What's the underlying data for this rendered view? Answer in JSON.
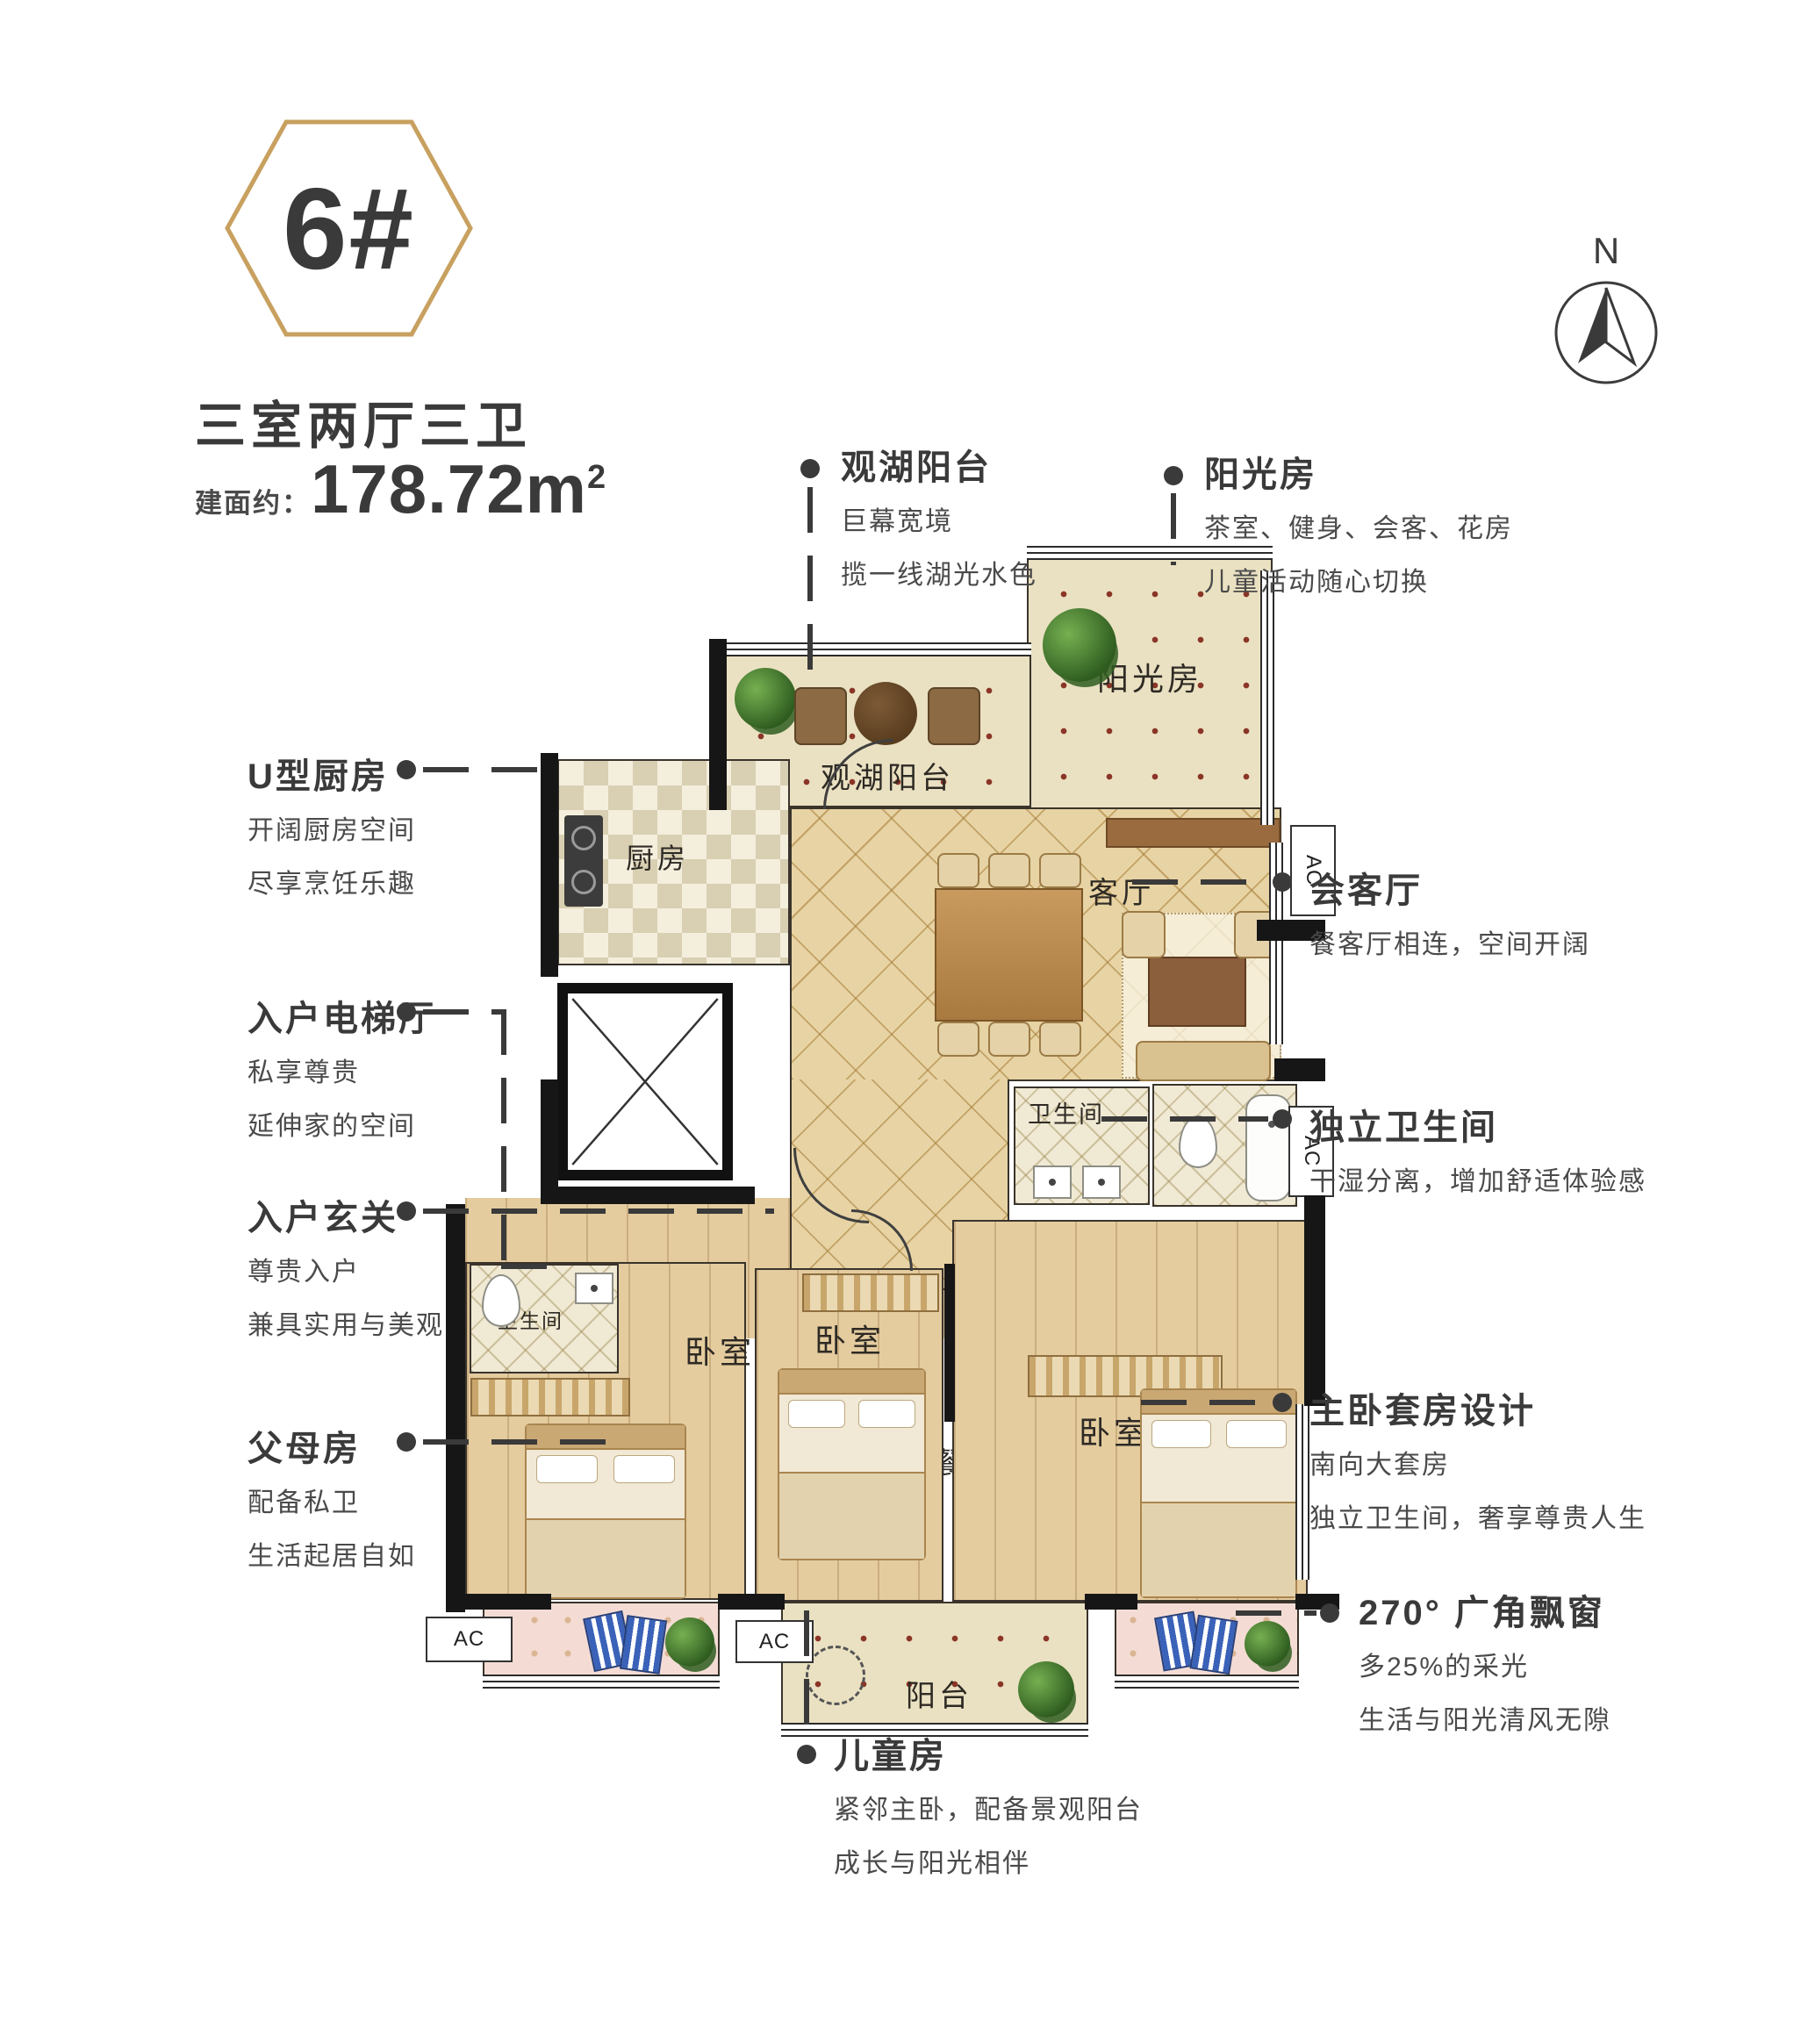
{
  "badge": {
    "number": "6#"
  },
  "header": {
    "title": "三室两厅三卫",
    "area_prefix": "建面约：",
    "area_value": "178.72m",
    "area_sup": "2"
  },
  "compass": {
    "north": "N"
  },
  "plan": {
    "rooms": {
      "sunroom": "阳光房",
      "lake_balcony": "观湖阳台",
      "kitchen": "厨房",
      "dining": "餐厅",
      "living": "客厅",
      "bathroom": "卫生间",
      "bedroom": "卧室",
      "balcony": "阳台",
      "ac_label": "AC"
    }
  },
  "annotations": {
    "lake_balcony": {
      "title": "观湖阳台",
      "line1": "巨幕宽境",
      "line2": "揽一线湖光水色"
    },
    "sunroom": {
      "title": "阳光房",
      "line1": "茶室、健身、会客、花房",
      "line2": "儿童活动随心切换"
    },
    "kitchen": {
      "title": "U型厨房",
      "line1": "开阔厨房空间",
      "line2": "尽享烹饪乐趣"
    },
    "elevator": {
      "title": "入户电梯厅",
      "line1": "私享尊贵",
      "line2": "延伸家的空间"
    },
    "foyer": {
      "title": "入户玄关",
      "line1": "尊贵入户",
      "line2": "兼具实用与美观"
    },
    "parents": {
      "title": "父母房",
      "line1": "配备私卫",
      "line2": "生活起居自如"
    },
    "reception": {
      "title": "会客厅",
      "line1": "餐客厅相连，空间开阔"
    },
    "independent_bath": {
      "title": "独立卫生间",
      "line1": "干湿分离，增加舒适体验感"
    },
    "master": {
      "title": "主卧套房设计",
      "line1": "南向大套房",
      "line2": "独立卫生间，奢享尊贵人生"
    },
    "bay_window": {
      "title": "270° 广角飘窗",
      "line1": "多25%的采光",
      "line2": "生活与阳光清风无隙"
    },
    "children": {
      "title": "儿童房",
      "line1": "紧邻主卧，配备景观阳台",
      "line2": "成长与阳光相伴"
    }
  },
  "colors": {
    "accent_gold": "#C8A05F",
    "text_dark": "#3A3A3A",
    "wall_black": "#161616",
    "tile_beige": "#E7D3A4",
    "dot_tile": "#EAE1C2",
    "wood": "#E4CC9F",
    "bay_pink": "#F4DCD4"
  }
}
